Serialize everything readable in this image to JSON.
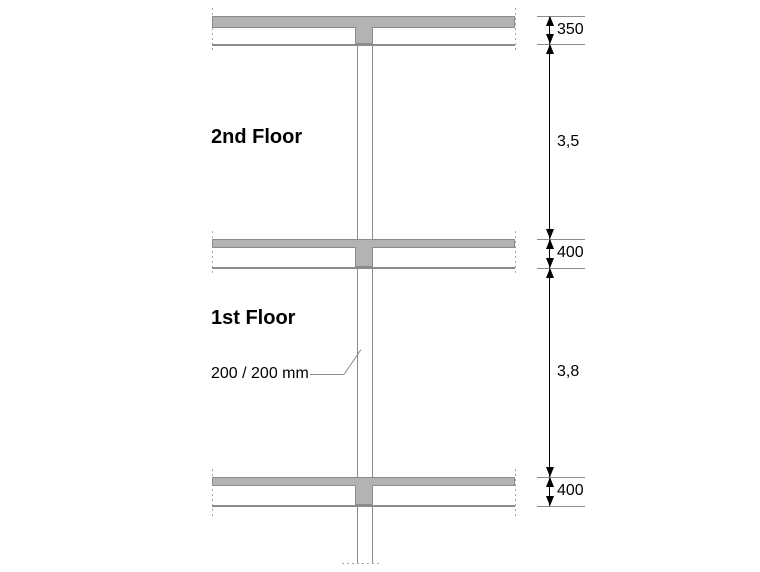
{
  "theme": {
    "background": "#ffffff",
    "slab_fill": "#b3b3b3",
    "line_gray": "#8c8c8c",
    "dash_gray": "#a6a6a6",
    "ink": "#000000"
  },
  "floors": [
    {
      "label": "2nd Floor"
    },
    {
      "label": "1st Floor"
    }
  ],
  "column": {
    "label": "200 / 200 mm"
  },
  "dimensions": [
    {
      "label": "350"
    },
    {
      "label": "3,5"
    },
    {
      "label": "400"
    },
    {
      "label": "3,8"
    },
    {
      "label": "400"
    }
  ]
}
